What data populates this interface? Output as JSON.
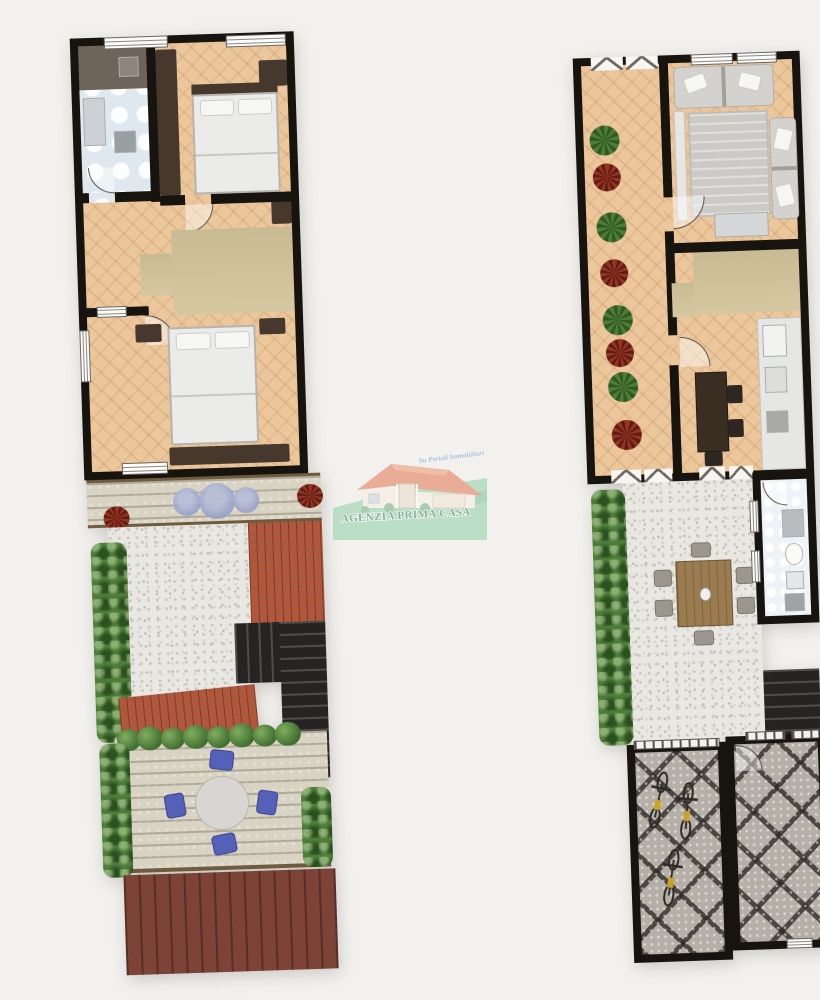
{
  "watermark": {
    "agency_name": "AGENZIA PRIMA CASA",
    "tagline": "Su Portali Immobiliari",
    "banner_color": "#8ed1a6",
    "text_color": "#2a7d52",
    "roof_color": "#e2744f",
    "tagline_color": "#6f9bd8"
  },
  "palette": {
    "background": "#f2f1ee",
    "wall": "#17130f",
    "wood_floor": "#ecc79c",
    "closet_tan": "#d3c59b",
    "bath_tile": "#dfe8ee",
    "gravel": "#e9e7e1",
    "terracotta_roof": "#b0573c",
    "deck_light": "#d8d3c3",
    "deck_maroon": "#7c4336",
    "cobblestone": "#b4afa7",
    "hedge_green": "#4e7c3a",
    "stairs_dark": "#262422",
    "furniture_dark": "#46382c",
    "mosaic_blue": "#93a0c6",
    "chair_blue": "#5560b8"
  },
  "plans": {
    "left": {
      "label": "upper floor with garden",
      "depicts": [
        "bathroom-kitchen",
        "bedroom-1",
        "hallway",
        "bedroom-2",
        "wood-deck-with-mosaic-tables",
        "gravel-garden",
        "terracotta-roof-sections",
        "dark-staircase",
        "deck-terrace-with-round-table",
        "maroon-lower-deck",
        "hedges",
        "flower-pots"
      ]
    },
    "right": {
      "label": "ground floor with courtyard",
      "depicts": [
        "side-terrace-with-potted-plants",
        "living-room-two-sofas",
        "closet-hall",
        "kitchen-dining",
        "gravel-courtyard",
        "outdoor-dining-table",
        "narrow-bathroom",
        "dark-staircase",
        "cobblestone-bicycle-storage",
        "cobblestone-yard",
        "hedge"
      ]
    }
  }
}
